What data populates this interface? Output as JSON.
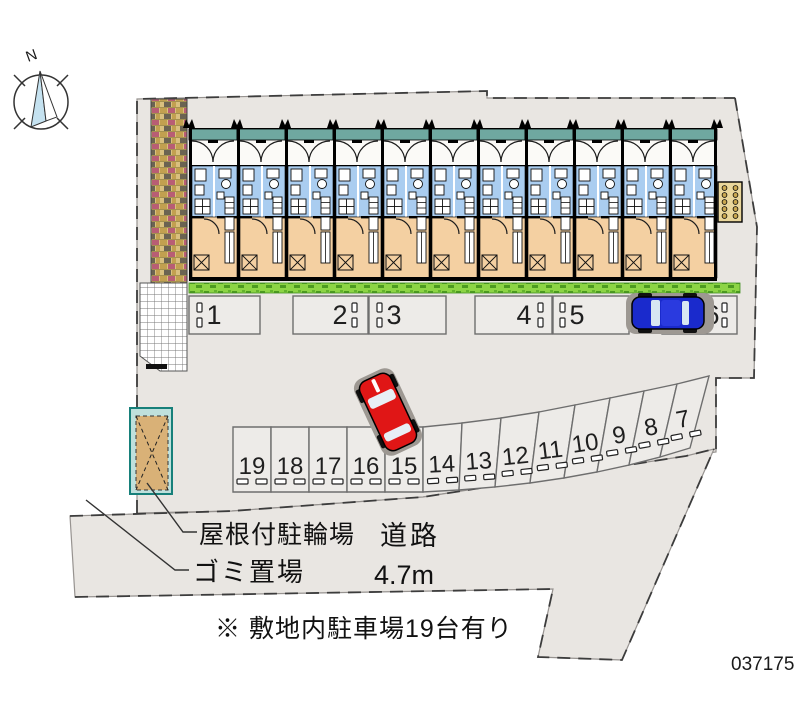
{
  "compass": {
    "north_label": "N"
  },
  "labels": {
    "bicycle_parking": "屋根付駐輪場",
    "garbage_area": "ゴミ置場",
    "road": "道路",
    "road_width": "4.7m",
    "note": "※ 敷地内駐車場19台有り",
    "plan_number": "037175"
  },
  "parking": {
    "upper_row": [
      "1",
      "2",
      "3",
      "4",
      "5",
      "6"
    ],
    "lower_row": [
      "19",
      "18",
      "17",
      "16",
      "15",
      "14",
      "13",
      "12",
      "11",
      "10",
      "9",
      "8",
      "7"
    ]
  },
  "building": {
    "unit_count": 11
  },
  "cars": [
    {
      "name": "blue-car",
      "space": "6",
      "color": "#1a2acc"
    },
    {
      "name": "red-car",
      "near_space": "15",
      "color": "#e01616"
    }
  ],
  "colors": {
    "site_gray": "#e9e6e2",
    "roof_teal": "#6fa8a0",
    "wet_area_blue": "#aacdf0",
    "room_tan": "#f4d0a2",
    "grass_green": "#8cd445",
    "brick_base": "#d9c07f",
    "shed_tan": "#d9b177",
    "shed_frame": "#2f9e98"
  }
}
